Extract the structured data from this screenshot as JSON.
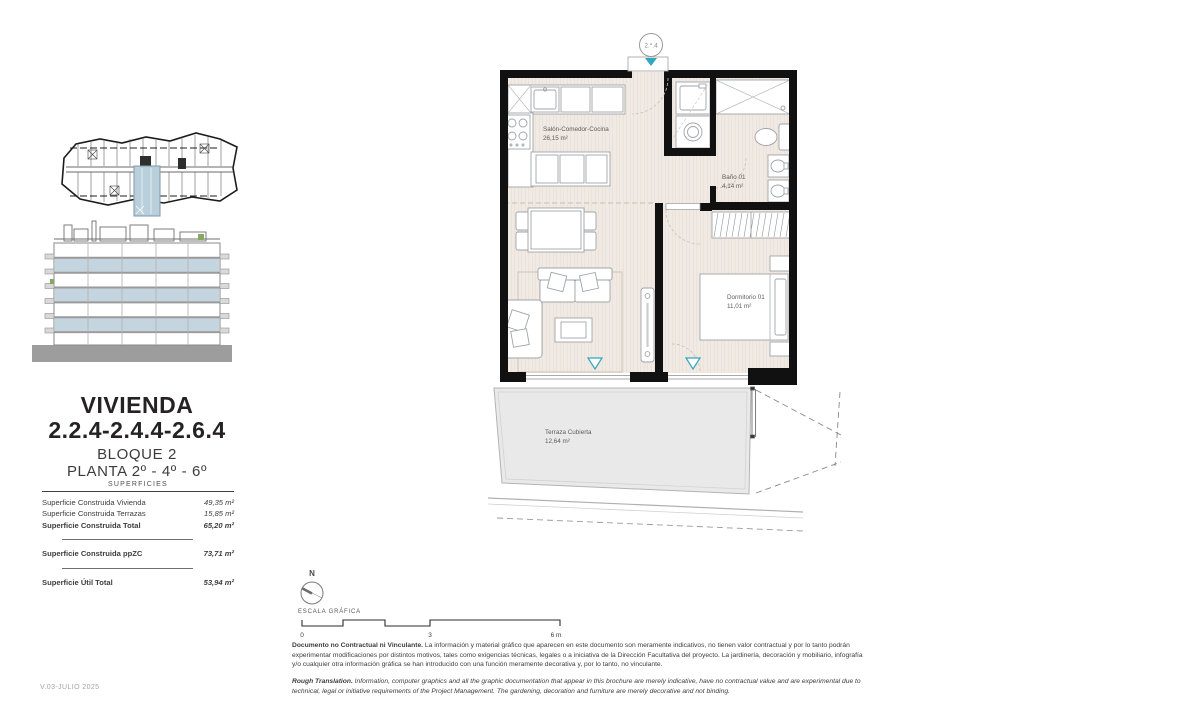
{
  "title": {
    "line1": "VIVIENDA",
    "line2": "2.2.4-2.4.4-2.6.4",
    "line3": "BLOQUE 2",
    "line4": "PLANTA 2º - 4º - 6º"
  },
  "superficies": {
    "heading": "SUPERFICIES",
    "rows": [
      {
        "label": "Superficie Construida Vivienda",
        "value": "49,35 m²"
      },
      {
        "label": "Superficie Construida Terrazas",
        "value": "15,85 m²"
      },
      {
        "label": "Superficie Construida Total",
        "value": "65,20 m²"
      },
      {
        "label": "Superficie Construida ppZC",
        "value": "73,71 m²"
      },
      {
        "label": "Superficie Útil Total",
        "value": "53,94 m²"
      }
    ]
  },
  "plan": {
    "unit_marker": "2.*.4",
    "rooms": [
      {
        "name": "Salón-Comedor-Cocina",
        "area": "26,15 m²"
      },
      {
        "name": "Baño 01",
        "area": "4,14 m²"
      },
      {
        "name": "Dormitorio 01",
        "area": "11,01 m²"
      },
      {
        "name": "Terraza Cubierta",
        "area": "12,64 m²"
      }
    ]
  },
  "compass": {
    "north_label": "N",
    "caption": "ESCALA GRÁFICA"
  },
  "scalebar": {
    "start": "0",
    "mid": "3",
    "end": "6 m"
  },
  "footer": {
    "disclaimer_lead": "Documento no Contractual ni Vinculante.",
    "disclaimer_body": " La información y material gráfico que aparecen en este documento son meramente indicativos, no tienen valor contractual y por lo tanto podrán experimentar modificaciones por distintos motivos, tales como exigencias técnicas, legales o a iniciativa de la Dirección Facultativa del proyecto. La jardinería, decoración y mobiliario, infografía y/o cualquier otra información gráfica se han introducido con una función meramente decorativa y, por lo tanto, no vinculante.",
    "translation_lead": "Rough Translation.",
    "translation_body": " Information, computer graphics and all the graphic documentation that appear in this brochure are merely indicative, have no contractual value and are experimental due to technical, legal or initiative requirements of the Project Management. The gardening, decoration and furniture are merely decorative and not binding."
  },
  "version": "V.03-JULIO 2025",
  "colors": {
    "accent_teal": "#2fa7bc",
    "highlight_blue": "#bfd2de",
    "wall_black": "#111111",
    "floor_beige": "#f1e9e3",
    "terrace_gray": "#e9e9e9"
  }
}
